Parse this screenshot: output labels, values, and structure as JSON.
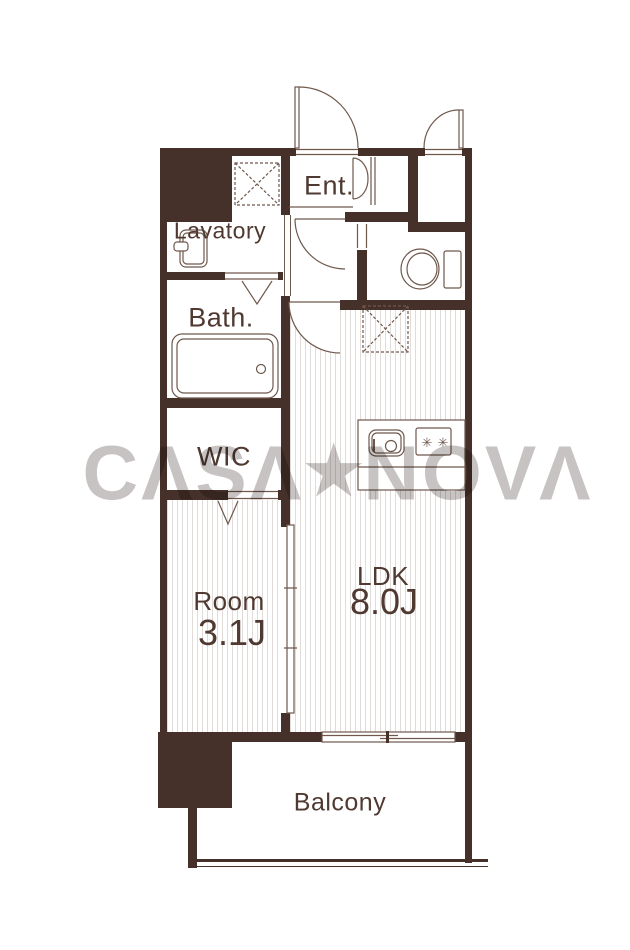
{
  "plan": {
    "rooms": [
      {
        "id": "ent",
        "label": "Ent."
      },
      {
        "id": "lavatory",
        "label": "Lavatory"
      },
      {
        "id": "bath",
        "label": "Bath."
      },
      {
        "id": "wic",
        "label": "WIC"
      },
      {
        "id": "bedroom",
        "label": "Room",
        "size": "3.1J"
      },
      {
        "id": "ldk",
        "label": "LDK",
        "size": "8.0J"
      },
      {
        "id": "balcony",
        "label": "Balcony"
      }
    ],
    "watermark": {
      "left": "CΛSΛ",
      "star": "★",
      "right": "NOVΛ"
    },
    "stove": {
      "burner_glyph": "✳"
    },
    "fixtures": [
      "entrance-door",
      "service-door",
      "hall-door",
      "ldk-door",
      "shoe-cabinet-folding-door",
      "washer-space",
      "washbasin",
      "bathtub",
      "toilet",
      "closet",
      "kitchen-counter",
      "kitchen-sink",
      "stove-2-burner",
      "sliding-partition",
      "bath-folding-door",
      "wic-folding-door",
      "balcony-window"
    ],
    "colors": {
      "wall": "#46312a",
      "line": "#6f584c",
      "text": "#4f3931",
      "floor_stripe": "#e2dcd8",
      "watermark": "#c6c3c2",
      "background": "#ffffff"
    }
  }
}
